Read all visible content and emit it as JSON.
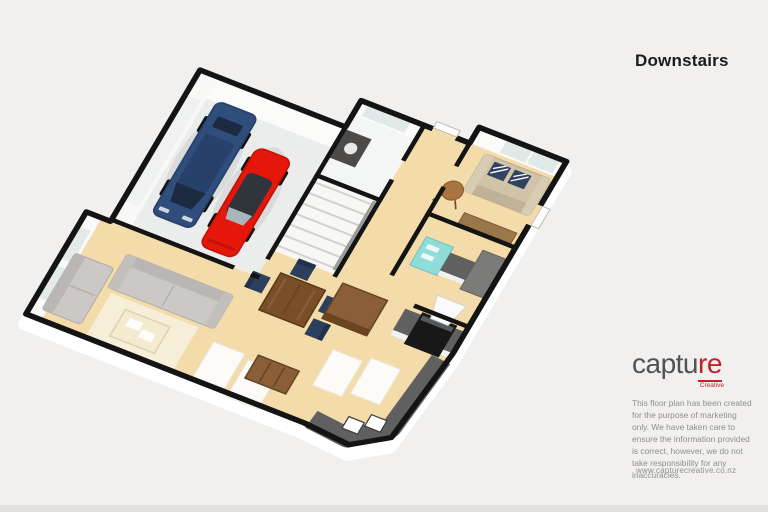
{
  "header": {
    "title": "Downstairs"
  },
  "branding": {
    "logo_text_main": "captu",
    "logo_text_accent": "re",
    "logo_subtext": "Creative",
    "website_url": "www.capturecreative.co.nz"
  },
  "disclaimer": {
    "text": "This floor plan has been created for the purpose of marketing only. We have taken care to ensure the information provided is correct, however, we do not take responsibility for any inaccuracies."
  },
  "floor_plan": {
    "view": "3d-isometric-floor-plan",
    "level": "Downstairs",
    "rooms": [
      {
        "name": "garage",
        "contents": [
          "blue SUV",
          "red sports car"
        ]
      },
      {
        "name": "living-room",
        "contents": [
          "two grey sofas",
          "coffee table",
          "cream rug"
        ]
      },
      {
        "name": "dining-area",
        "contents": [
          "wooden dining table",
          "four navy chairs",
          "wooden island bench",
          "wooden sideboard"
        ]
      },
      {
        "name": "kitchen",
        "contents": [
          "dark benchtops",
          "oven with rangehood",
          "double sink",
          "white floor mats"
        ]
      },
      {
        "name": "utility",
        "contents": [
          "teal fridge",
          "benchtop",
          "tall grey cabinet"
        ]
      },
      {
        "name": "lounge",
        "contents": [
          "beige sofa with navy cushions",
          "round side table",
          "wooden bench",
          "window"
        ]
      },
      {
        "name": "bathroom",
        "contents": [
          "dark vanity",
          "window"
        ]
      },
      {
        "name": "stairs",
        "contents": [
          "staircase treads"
        ]
      },
      {
        "name": "hallway",
        "contents": []
      }
    ]
  },
  "colors": {
    "background": "#f1f0ee",
    "bottom_strip": "#e3e2e0",
    "wall": "#141414",
    "wall_face": "#ffffff",
    "floor_tan": "#f4dcaa",
    "floor_garage": "#ebecec",
    "floor_white": "#f4f5f5",
    "window_pane": "#e0e8e8",
    "car_blue": "#2f4e7c",
    "car_blue_dark": "#26406a",
    "car_glass": "#1c2a42",
    "car_red": "#e5170b",
    "car_red_dark": "#c01208",
    "canopy_gray": "#30353c",
    "sofa_gray": "#cbc8c5",
    "sofa_gray_dark": "#b9b6b3",
    "sofa_beige": "#cfc3a9",
    "sofa_beige_dark": "#b4a78c",
    "cushion_navy": "#31435f",
    "chair_navy": "#2d3f5e",
    "chair_navy_dark": "#22314a",
    "wood_mid": "#8a5e36",
    "wood_dark": "#654426",
    "wood_table": "#7a4f28",
    "wood_light": "#a9743f",
    "counter_gray": "#606060",
    "cabinet_gray": "#7b7b79",
    "appliance_black": "#181818",
    "fridge_teal": "#8fdcd9",
    "vanity_gray": "#4c4b49",
    "rug_cream": "#f6eed7",
    "mat_white": "#fcfbf7",
    "title_color": "#1c1c1c",
    "logo_gray": "#515254",
    "logo_red": "#c2212a",
    "text_muted": "#8e8e8c"
  }
}
